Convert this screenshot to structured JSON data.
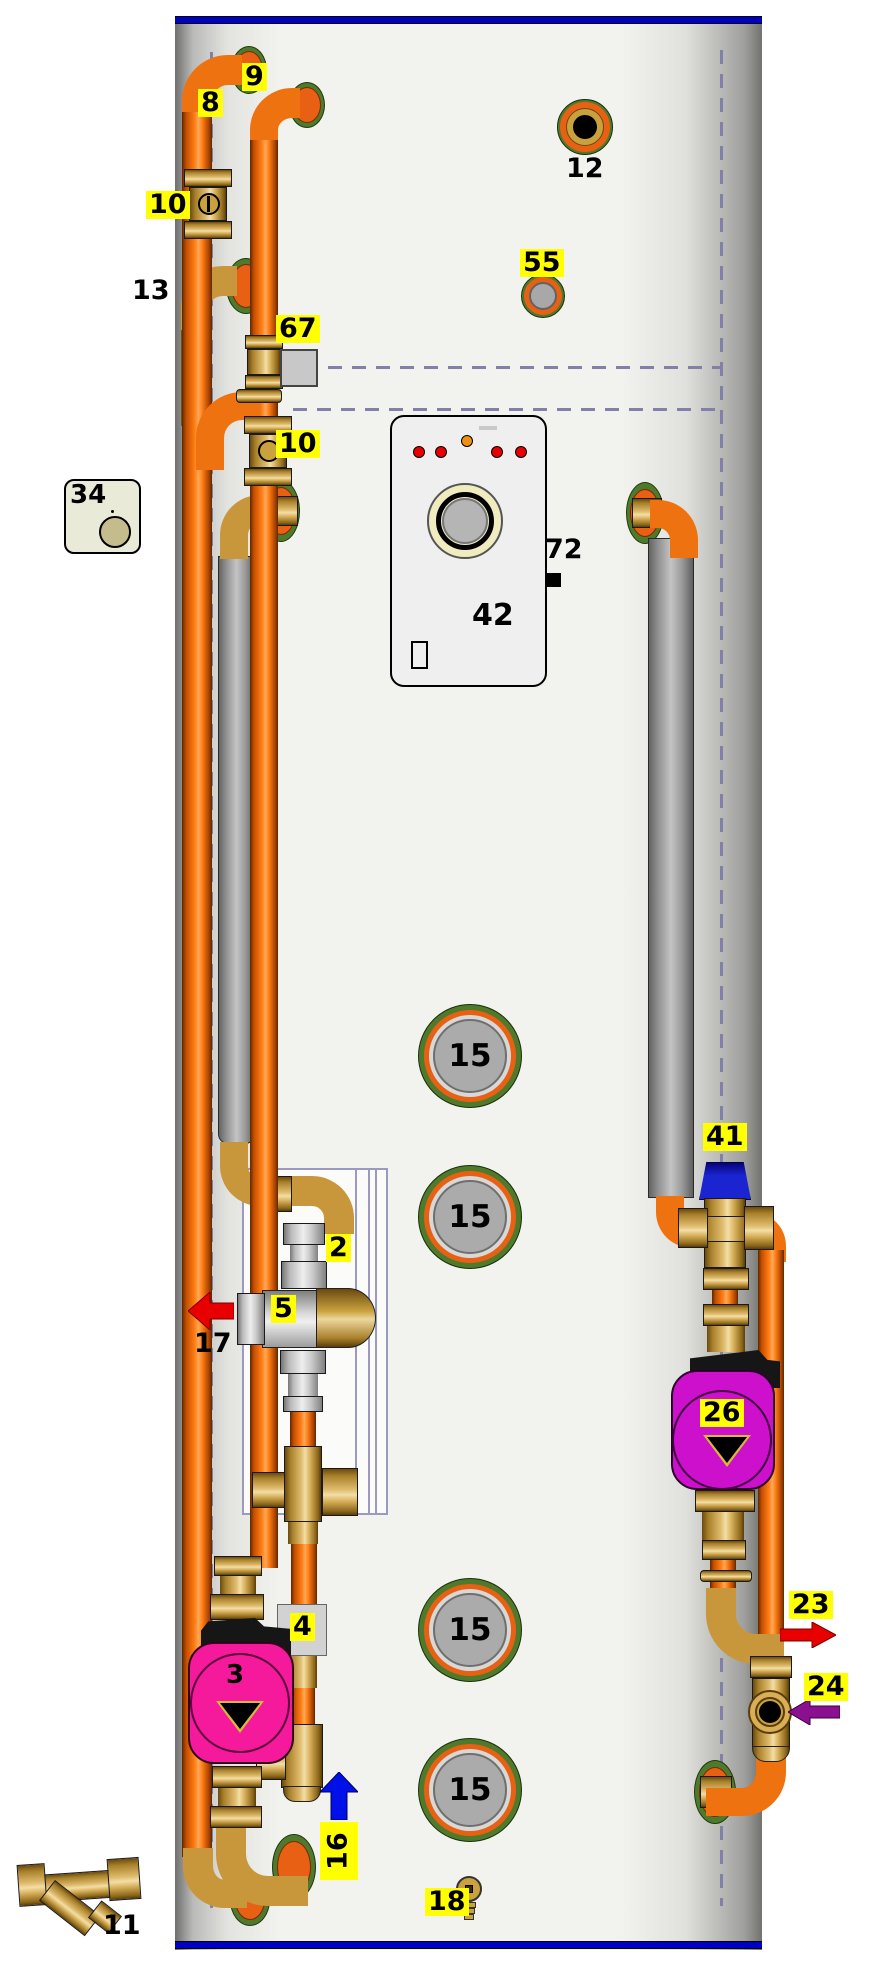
{
  "diagram": {
    "kind": "thermal-store cylinder installation schematic",
    "labels": {
      "pipe8": "8",
      "pipe9": "9",
      "valve10_upper": "10",
      "elbow13": "13",
      "port12": "12",
      "port55": "55",
      "sensor67": "67",
      "valve10_lower": "10",
      "stat34": "34",
      "panel42": "42",
      "sensor72": "72",
      "port15": "15",
      "fitting2": "2",
      "valve5": "5",
      "flow17": "17",
      "valve41": "41",
      "pump26": "26",
      "flow23": "23",
      "flow24": "24",
      "pump3": "3",
      "valve4": "4",
      "flow16": "16",
      "drain18": "18",
      "strainer11": "11"
    },
    "arrows": [
      {
        "label": "17",
        "direction": "left",
        "color": "#E80000"
      },
      {
        "label": "23",
        "direction": "right",
        "color": "#E80000"
      },
      {
        "label": "24",
        "direction": "left",
        "color": "#8A1090"
      },
      {
        "label": "16",
        "direction": "up",
        "color": "#0010E8"
      }
    ],
    "pumps": [
      {
        "label": "3",
        "body_color": "#F5199B"
      },
      {
        "label": "26",
        "body_color": "#CC10CC"
      }
    ],
    "panel": {
      "id_label": "42",
      "led_colors": [
        "#E80000",
        "#E80000",
        "#F09010",
        "#E80000",
        "#E80000"
      ]
    },
    "colors": {
      "highlight_label": "#FFFF00",
      "pipe_orange": "#EF7210",
      "brass": "#C9973B",
      "tank_border_blue": "#0000C4",
      "coil_dashed_line": "#8080A8",
      "arrow_red": "#E80000",
      "arrow_blue": "#0010E8",
      "arrow_purple": "#8A1090",
      "pump3_magenta": "#F5199B",
      "pump26_magenta": "#CC10CC"
    }
  }
}
